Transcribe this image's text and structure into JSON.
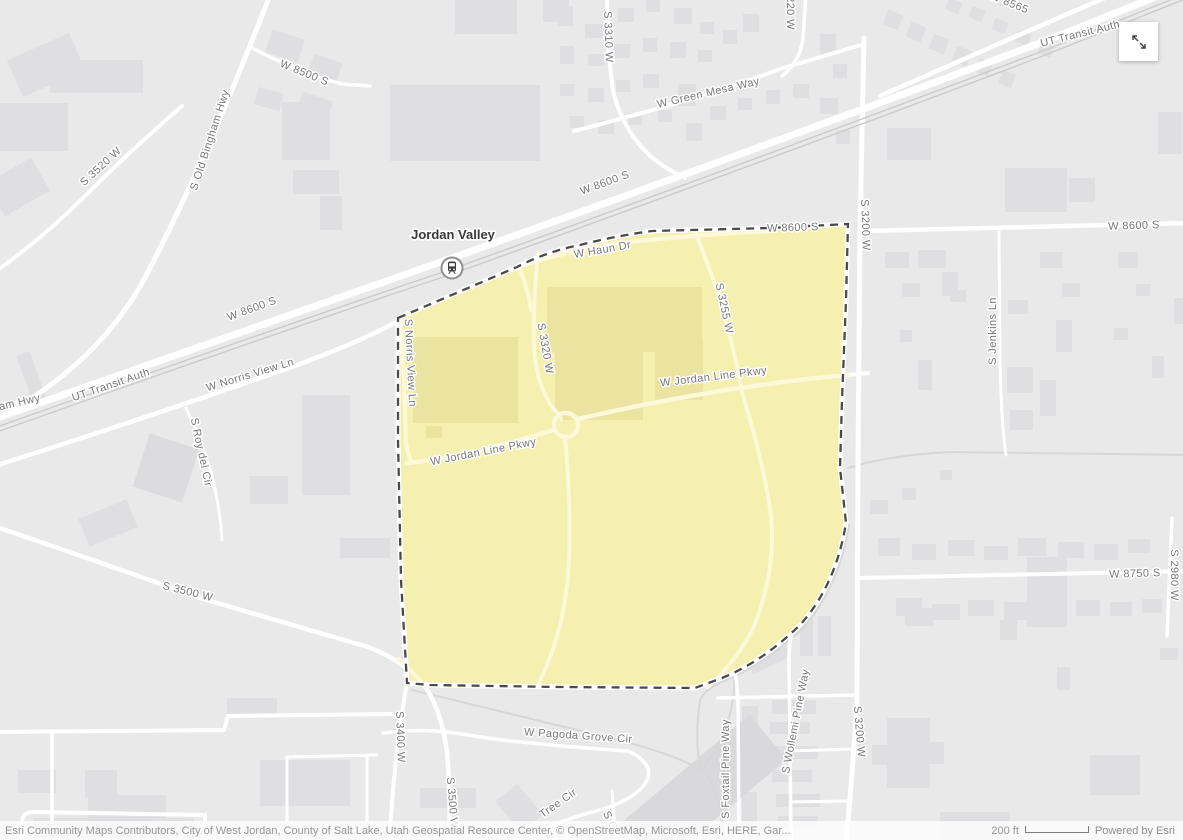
{
  "map": {
    "station": {
      "name": "Jordan Valley",
      "icon": "train-station-icon"
    },
    "highlight_colors": {
      "parcel_fill": "#f5efb0",
      "parcel_border": "#4a4a4a"
    },
    "base_colors": {
      "background": "#e9e9e9",
      "building": "#dfdfe1",
      "road": "#ffffff",
      "rail": "#cbcbcb",
      "parcel_road": "#fcf8d8",
      "parcel_building": "#ebe4a1"
    },
    "labels": [
      {
        "text": "W 8500 S"
      },
      {
        "text": "S 3520 W"
      },
      {
        "text": "S Old Bingham Hwy"
      },
      {
        "text": "S 3310 W"
      },
      {
        "text": "220 W"
      },
      {
        "text": "W Green Mesa Way"
      },
      {
        "text": "W 8565"
      },
      {
        "text": "UT Transit Auth"
      },
      {
        "text": "UT Transit Auth"
      },
      {
        "text": "W 8600 S"
      },
      {
        "text": "W 8600 S"
      },
      {
        "text": "W Norris View Ln"
      },
      {
        "text": "gham Hwy"
      },
      {
        "text": "S Roy del Cir"
      },
      {
        "text": "S 3500 W"
      },
      {
        "text": "S 3400 W"
      },
      {
        "text": "W Pagoda Grove Cir"
      },
      {
        "text": "Tree Cir"
      },
      {
        "text": "S C"
      },
      {
        "text": "S Foxtail Pine Way"
      },
      {
        "text": "S Wollemi Pine Way"
      },
      {
        "text": "S 3200 W"
      },
      {
        "text": "S 3200 W"
      },
      {
        "text": "W 8600 S"
      },
      {
        "text": "S Jenkins Ln"
      },
      {
        "text": "W 8750 S"
      },
      {
        "text": "S 2980 W"
      },
      {
        "text": "W 8600 S"
      },
      {
        "text": "W Haun Dr"
      },
      {
        "text": "S 3320 W"
      },
      {
        "text": "S 3255 W"
      },
      {
        "text": "W Jordan Line Pkwy"
      },
      {
        "text": "W Jordan Line Pkwy"
      },
      {
        "text": "S Norris View Ln"
      },
      {
        "text": "S 3500 W"
      }
    ]
  },
  "controls": {
    "expand_icon": "expand-diagonal-arrows"
  },
  "attribution": {
    "sources": "Esri Community Maps Contributors, City of West Jordan, County of Salt Lake, Utah Geospatial Resource Center, © OpenStreetMap, Microsoft, Esri, HERE, Gar...",
    "scale_label": "200 ft",
    "powered_by": "Powered by Esri"
  }
}
